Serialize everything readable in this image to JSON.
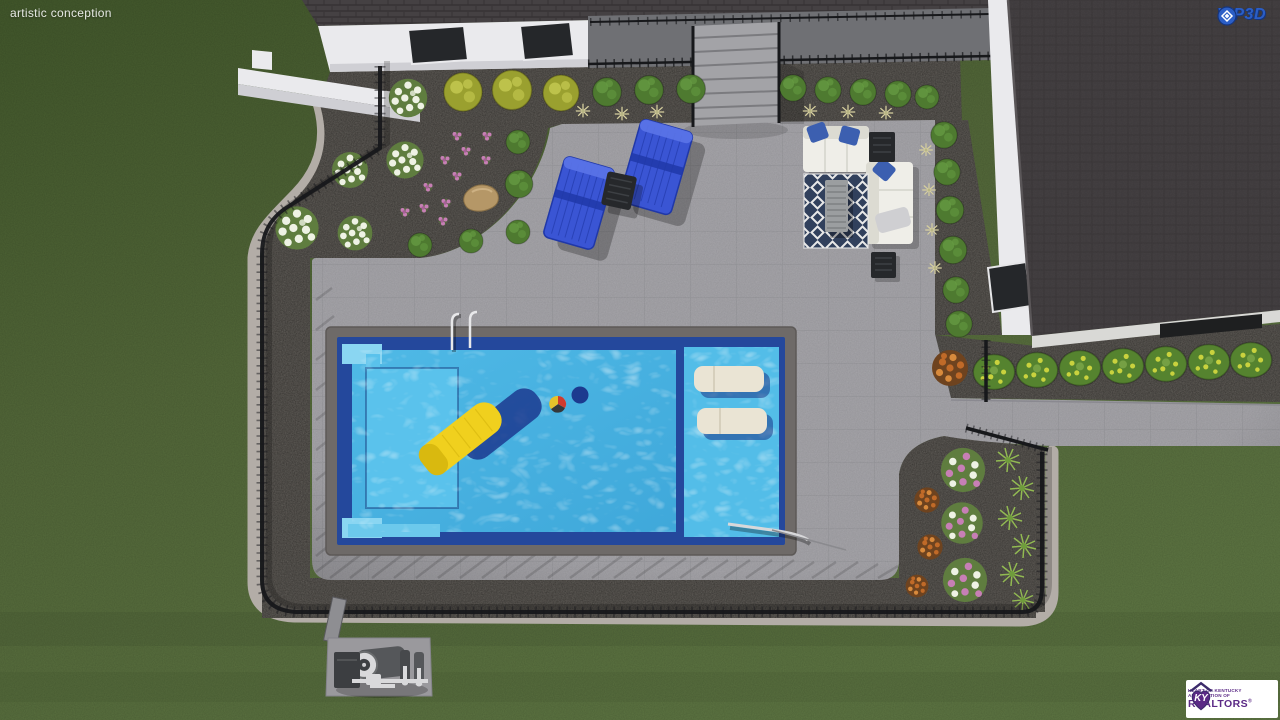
{
  "overlay": {
    "watermark": "artistic conception",
    "vip3d": {
      "label": "VIP3D"
    },
    "realtor": {
      "monogram": "KY",
      "line1": "HEART OF KENTUCKY",
      "line2": "ASSOCIATION OF",
      "name": "REALTORS",
      "registered": "®"
    }
  },
  "palette": {
    "grass1": "#43592c",
    "grass2": "#54693a",
    "grass3": "#5e7643",
    "wall": "#eaeaed",
    "wall_shade": "#cfcfd4",
    "roof": "#454143",
    "roof_line": "#363234",
    "window": "#25272a",
    "porch": "#6f7074",
    "stair": "#a3a3a7",
    "gravel": "#534f4a",
    "curb": "#b3ada7",
    "patio": "#a2a1a6",
    "coping": "#6e6a68",
    "pool_deep": "#24489c",
    "pool_water": "#46b2e2",
    "pool_step": "#5ac2ec",
    "pool_step_lt": "#8ad6f2",
    "pool_ledge": "#53bde8",
    "lounger": "#eae4d4",
    "float": "#f0d01e",
    "float_dk": "#d9b90f",
    "ball_red": "#cf3b2e",
    "ball_yellow": "#e6c32b",
    "ball_dark": "#35383b",
    "chaise": "#3a55d4",
    "chaise_dk": "#2038a8",
    "chaise_lt": "#5b74e8",
    "table_dk": "#26282b",
    "sofa": "#efeee8",
    "sofa_shade": "#dcdbd2",
    "pillow": "#3c5fb0",
    "rug": "#31405c",
    "rug_white": "#e8e8e8",
    "ctable": "#9b9ea0",
    "towel": "#cfcfd2",
    "fence": "#17181b",
    "pad": "#9a999d",
    "equip_dk": "#3c3e41",
    "equip_lt": "#d9d9db",
    "bush": "#4e7a30",
    "bush_lt": "#659a42",
    "bushy": "#9aa02f",
    "bushy_lt": "#c6ca52",
    "flw_base": "#5f7d3f",
    "flw_white": "#eef2e4",
    "pink": "#c77fb5",
    "tuft": "#d6cf9e",
    "spiky": "#92ba52",
    "hedge": "#55832f",
    "hedge_dot": "#c9d23e",
    "orange": "#c06a28",
    "orange_lt": "#d88a3c",
    "orange_base": "#6e431f",
    "boulder": "#b59767",
    "logo_blue": "#2b5ec6",
    "logo_blue_dk": "#16357c",
    "logo_purple": "#5b2a86",
    "logo_purple_dk": "#3b2a6b"
  }
}
